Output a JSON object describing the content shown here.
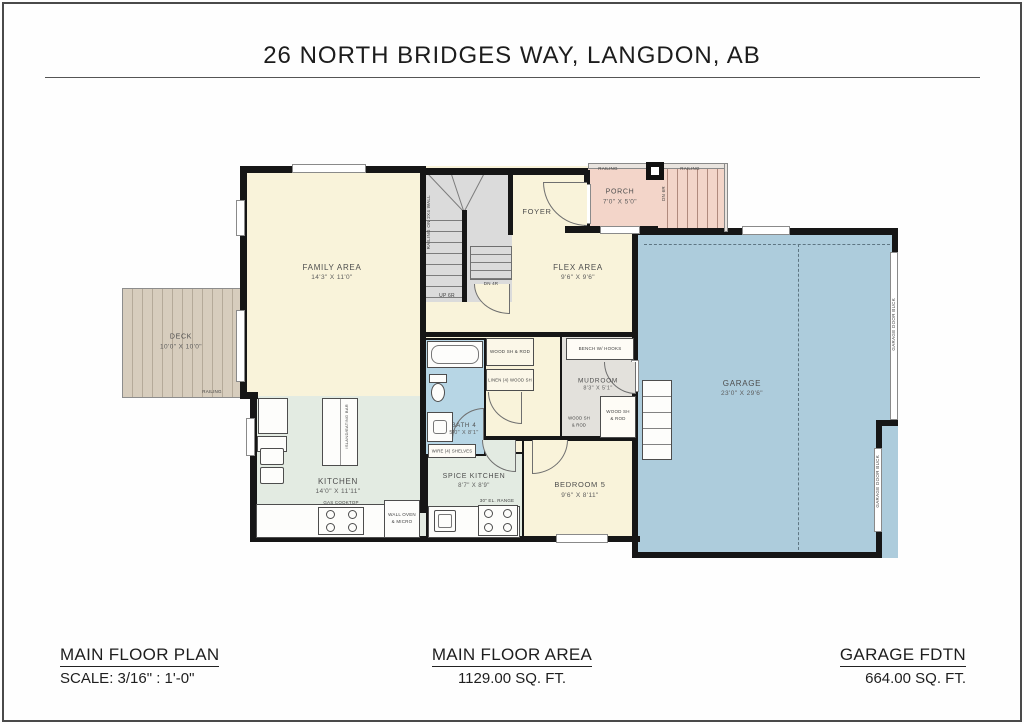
{
  "title": "26 NORTH BRIDGES WAY, LANGDON, AB",
  "footer": {
    "plan": {
      "heading": "MAIN FLOOR PLAN",
      "detail": "SCALE: 3/16\" : 1'-0\""
    },
    "area": {
      "heading": "MAIN FLOOR AREA",
      "detail": "1129.00 SQ. FT."
    },
    "garage": {
      "heading": "GARAGE FDTN",
      "detail": "664.00 SQ. FT."
    }
  },
  "rooms": {
    "deck": {
      "name": "DECK",
      "dims": "10'0\" X 10'0\""
    },
    "family_area": {
      "name": "FAMILY AREA",
      "dims": "14'3\" X 11'0\""
    },
    "foyer": {
      "name": "FOYER"
    },
    "flex_area": {
      "name": "FLEX AREA",
      "dims": "9'6\" X 9'6\""
    },
    "porch": {
      "name": "PORCH",
      "dims": "7'0\" X 5'0\""
    },
    "garage": {
      "name": "GARAGE",
      "dims": "23'0\" X 29'6\""
    },
    "kitchen": {
      "name": "KITCHEN",
      "dims": "14'0\" X 11'11\""
    },
    "bath_4": {
      "name": "BATH 4",
      "dims": "5'0\" X 8'1\""
    },
    "spice_kitchen": {
      "name": "SPICE KITCHEN",
      "dims": "8'7\" X 8'9\""
    },
    "bedroom_5": {
      "name": "BEDROOM 5",
      "dims": "9'6\" X 8'11\""
    },
    "mudroom": {
      "name": "MUDROOM",
      "dims": "8'3\" X 5'1\""
    }
  },
  "annotations": {
    "railing": "RAILING",
    "railing_2x4": "RAILING ON 2X4 WALL",
    "up_6r": "UP 6R",
    "dn_4r": "DN 4R",
    "dn_6r": "DN 6R",
    "island": "ISLAND/EATING BAR",
    "gas_cooktop": "GAS COOKTOP",
    "wall_oven_1": "WALL OVEN",
    "wall_oven_2": "& MICRO",
    "el_range": "30\" EL. RANGE",
    "wire_shelves": "WIRE (4) SHELVES",
    "bench": "BENCH W/ HOOKS",
    "wood_sh_rod": "WOOD SH & ROD",
    "wood_sh": "WOOD SH",
    "and_rod": "& ROD",
    "linen": "LINEN (4) WOOD SH",
    "garage_door_buck": "GARAGE DOOR BUCK"
  },
  "colors": {
    "wall": "#161616",
    "cream": "#f9f3da",
    "porch_pink": "#f3d5c9",
    "garage_blue": "#adccdc",
    "bath_blue": "#b7d6e5",
    "kitchen_green": "#e3ebe2",
    "deck_tan": "#d7cdbd",
    "mudroom_grey": "#e3e1dc",
    "stair_grey": "#dbdbdb"
  }
}
